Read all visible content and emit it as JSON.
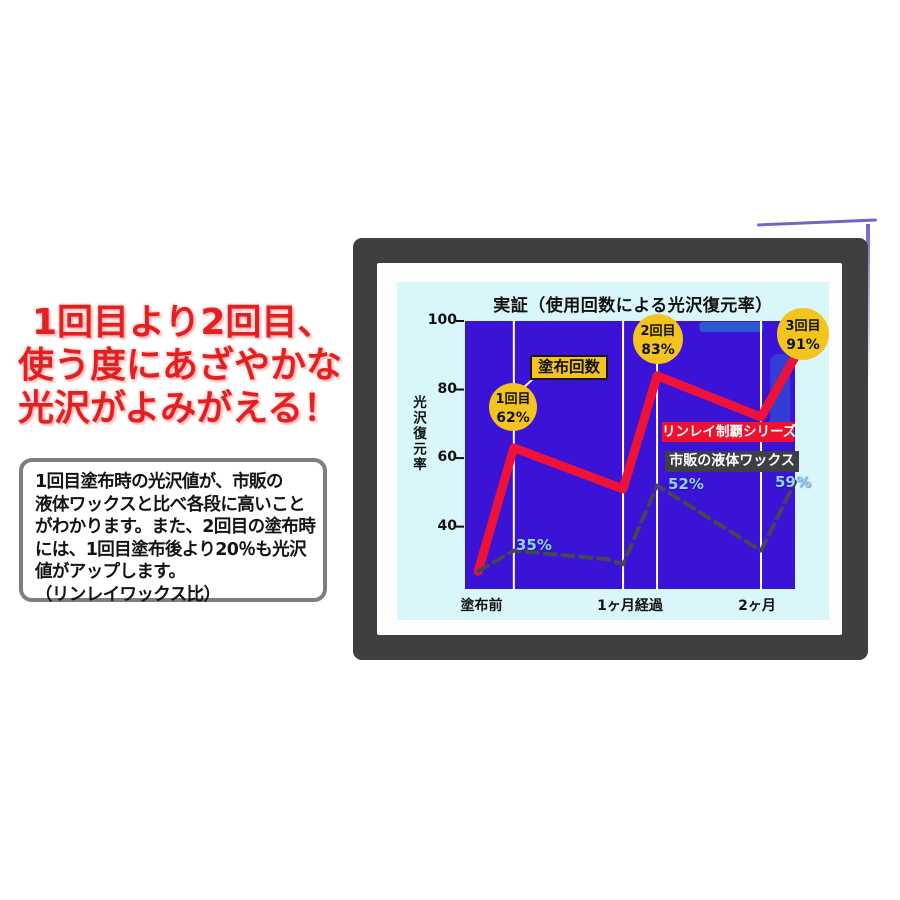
{
  "headline": {
    "lines": [
      "1回目より2回目、",
      "使う度にあざやかな",
      "光沢がよみがえる！"
    ],
    "color": "#e41f1f"
  },
  "info_box": {
    "lines": [
      "1回目塗布時の光沢値が、市販の",
      "液体ワックスと比べ各段に高いこと",
      "がわかります。また、2回目の塗布時",
      "には、1回目塗布後より20％も光沢",
      "値がアップします。",
      "（リンレイワックス比）"
    ]
  },
  "chart_data": {
    "type": "line",
    "title": "実証（使用回数による光沢復元率）",
    "ylabel": "光沢復元率",
    "yticks": [
      100,
      80,
      60,
      40
    ],
    "ylim": [
      21.8,
      100
    ],
    "grid": "vertical-white-lines",
    "plot_background": "#3a13d6",
    "panel_background": "#d9f6fa",
    "x_gridline_fracs": [
      0.148,
      0.479,
      0.582,
      0.897
    ],
    "x_axis_labels": [
      {
        "label": "塗布前",
        "frac": 0.05
      },
      {
        "label": "1ヶ月経過",
        "frac": 0.5
      },
      {
        "label": "2ヶ月",
        "frac": 0.885
      }
    ],
    "series": [
      {
        "name": "リンレイ制覇シリーズ",
        "color": "#ee1238",
        "style": "solid",
        "points": [
          {
            "x": 0.04,
            "v": 27
          },
          {
            "x": 0.148,
            "v": 63
          },
          {
            "x": 0.479,
            "v": 51
          },
          {
            "x": 0.582,
            "v": 84
          },
          {
            "x": 0.897,
            "v": 72
          },
          {
            "x": 1.0,
            "v": 89.5
          }
        ]
      },
      {
        "name": "市販の液体ワックス",
        "color": "#474752",
        "style": "dashed",
        "points": [
          {
            "x": 0.04,
            "v": 27
          },
          {
            "x": 0.148,
            "v": 33
          },
          {
            "x": 0.43,
            "v": 30.5
          },
          {
            "x": 0.479,
            "v": 29
          },
          {
            "x": 0.582,
            "v": 52
          },
          {
            "x": 0.897,
            "v": 33
          },
          {
            "x": 1.0,
            "v": 53
          }
        ]
      }
    ],
    "point_badges": [
      {
        "line1": "1回目",
        "line2": "62%",
        "cx": 116,
        "cy": 125,
        "r": 24
      },
      {
        "line1": "2回目",
        "line2": "83%",
        "cx": 261,
        "cy": 57,
        "r": 25
      },
      {
        "line1": "3回目",
        "line2": "91%",
        "cx": 406,
        "cy": 52,
        "r": 26
      }
    ],
    "series_tag": {
      "label": "塗布回数"
    },
    "value_labels": [
      {
        "text": "35%",
        "x": 119,
        "y": 254
      },
      {
        "text": "52%",
        "x": 271,
        "y": 193
      },
      {
        "text": "59%",
        "x": 378,
        "y": 191
      }
    ],
    "legend": [
      {
        "label": "リンレイ制覇シリーズ",
        "bg": "#ee1230",
        "color": "#ffffff"
      },
      {
        "label": "市販の液体ワックス",
        "bg": "#3e3e46",
        "color": "#ffffff"
      }
    ],
    "badge_color": "#f2c41d"
  }
}
